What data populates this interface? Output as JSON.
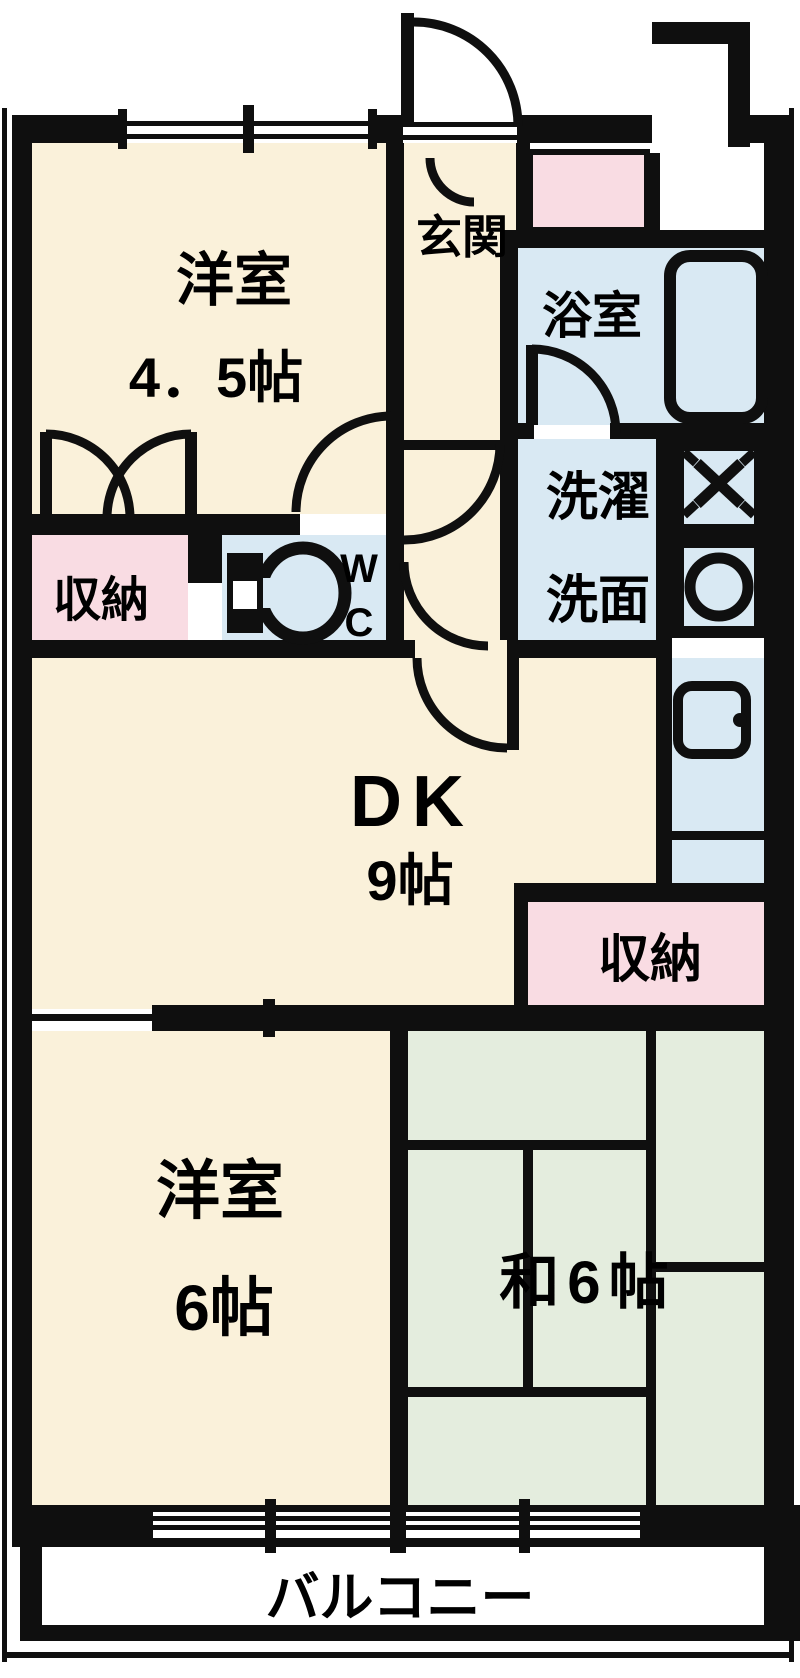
{
  "plan_type": "floorplan",
  "colors": {
    "wall": "#0f0f0f",
    "room_cream": "#FAF1DA",
    "room_pink": "#F9DCE3",
    "room_blue": "#D9E9F3",
    "tatami_green": "#E4EDDE",
    "white": "#FFFFFF"
  },
  "rooms": {
    "western_room_1": {
      "name_label": "洋室",
      "size_label": "4．5帖"
    },
    "entrance": {
      "label": "玄関"
    },
    "bathroom": {
      "label": "浴室"
    },
    "laundry": {
      "line1": "洗濯",
      "line2": "洗面"
    },
    "toilet": {
      "line1": "W",
      "line2": "C"
    },
    "storage_1": {
      "label": "収納"
    },
    "dining_kitchen": {
      "name_label": "DK",
      "size_label": "9帖"
    },
    "storage_2": {
      "label": "収納"
    },
    "western_room_2": {
      "name_label": "洋室",
      "size_label": "6帖"
    },
    "japanese_room": {
      "label": "和6帖"
    },
    "balcony": {
      "label": "バルコニー"
    }
  },
  "fixtures": {
    "bathtub": "bathtub-icon",
    "toilet_bowl": "toilet-icon",
    "gas_stove": "stove-x-icon",
    "kitchen_round_sink": "sink-circle-icon",
    "kitchen_counter_sink": "counter-sink-icon"
  }
}
